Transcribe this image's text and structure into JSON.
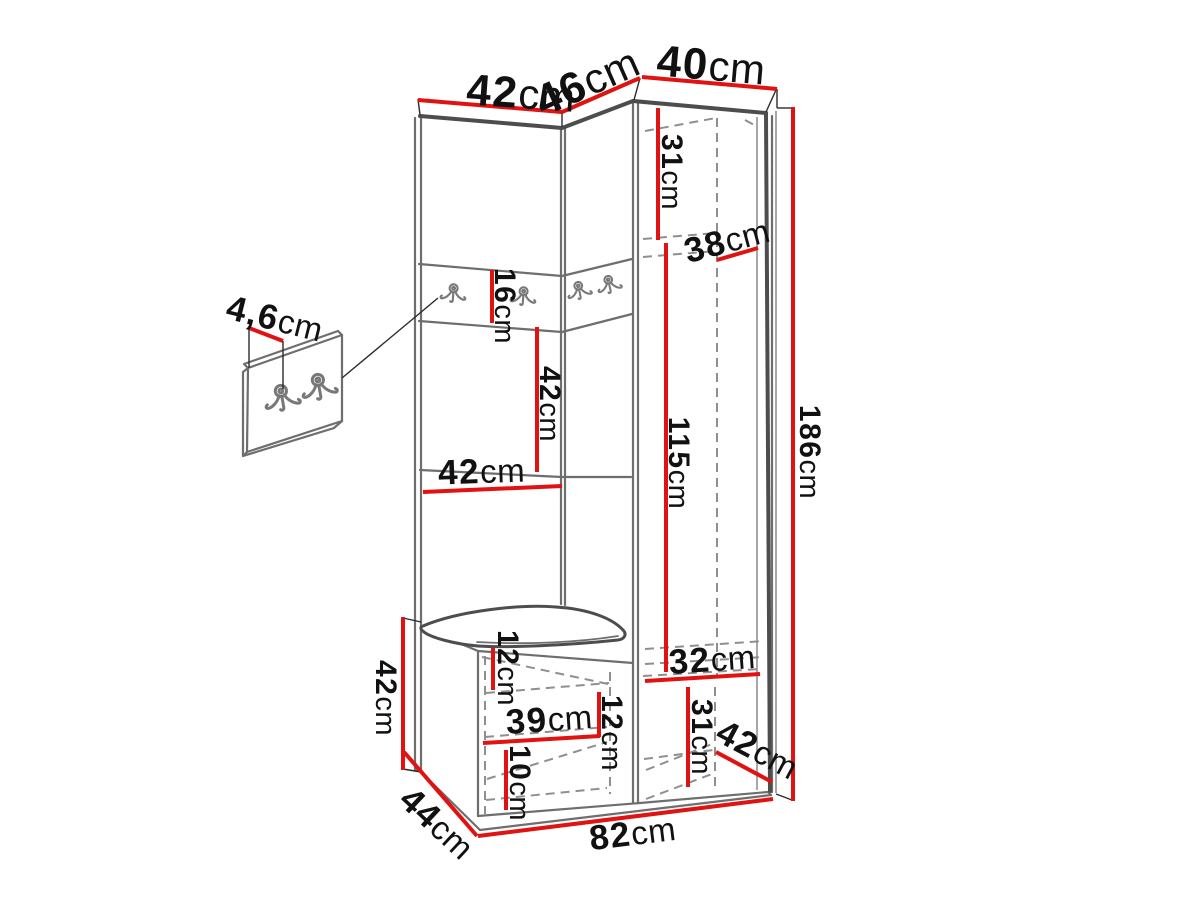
{
  "colors": {
    "dimension_red": "#e01212",
    "structure_gray": "#6e6e6e",
    "edge_dark_gray": "#4d4d4d",
    "hidden_dash_gray": "#8f8f8f",
    "label_black": "#111111",
    "background": "#ffffff"
  },
  "dims": {
    "top_left_width": {
      "value": "42",
      "unit": "cm"
    },
    "top_corner_width": {
      "value": "46",
      "unit": "cm"
    },
    "top_right_width": {
      "value": "40",
      "unit": "cm"
    },
    "upper_shelf_height": {
      "value": "31",
      "unit": "cm"
    },
    "interior_depth": {
      "value": "38",
      "unit": "cm"
    },
    "total_height": {
      "value": "186",
      "unit": "cm"
    },
    "hanging_height": {
      "value": "115",
      "unit": "cm"
    },
    "hook_panel_height": {
      "value": "16",
      "unit": "cm"
    },
    "open_mid_height": {
      "value": "42",
      "unit": "cm"
    },
    "open_mid_width": {
      "value": "42",
      "unit": "cm"
    },
    "hook_board_thickness": {
      "value": "4,6",
      "unit": "cm"
    },
    "bench_height": {
      "value": "42",
      "unit": "cm"
    },
    "seat_clearance": {
      "value": "12",
      "unit": "cm"
    },
    "shoe_shelf_width": {
      "value": "39",
      "unit": "cm"
    },
    "shoe_upper_height": {
      "value": "12",
      "unit": "cm"
    },
    "shoe_lower_height": {
      "value": "10",
      "unit": "cm"
    },
    "bottom_right_width": {
      "value": "32",
      "unit": "cm"
    },
    "bottom_right_height": {
      "value": "31",
      "unit": "cm"
    },
    "bottom_right_depth": {
      "value": "42",
      "unit": "cm"
    },
    "bench_depth": {
      "value": "44",
      "unit": "cm"
    },
    "total_width": {
      "value": "82",
      "unit": "cm"
    }
  }
}
